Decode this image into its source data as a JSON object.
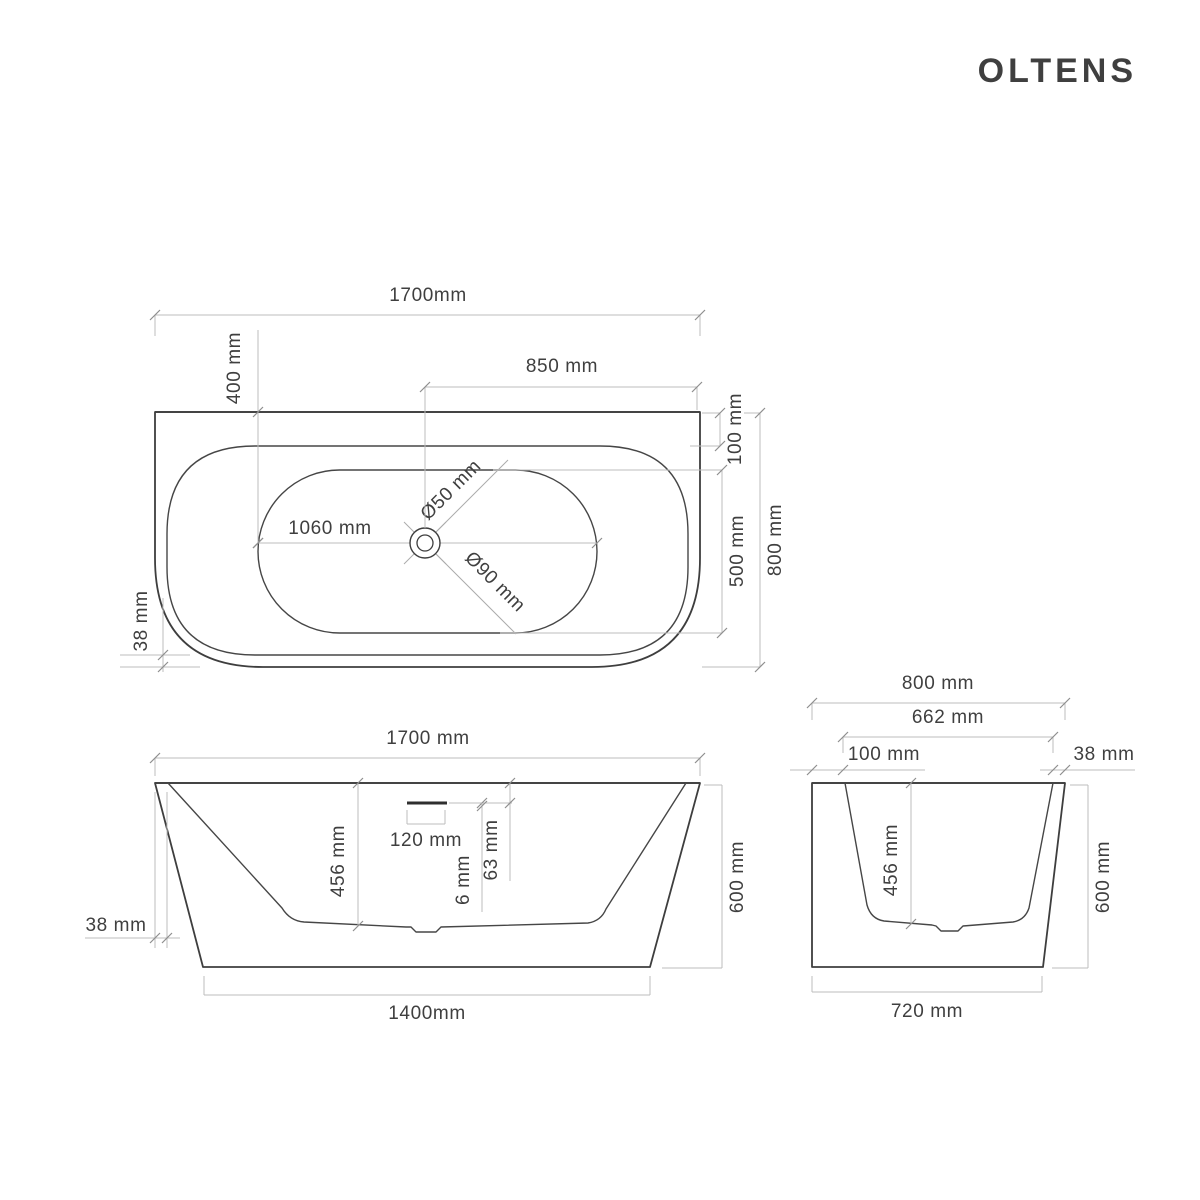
{
  "brand": {
    "logo": "OLTENS"
  },
  "colors": {
    "outline": "#3e3e3e",
    "dimension_lines": "#bcbcbc",
    "text": "#3f3f3f",
    "logo": "#242e4c"
  },
  "views": {
    "top": {
      "title": "top-view-of-bathtub",
      "dims": {
        "overall_length": "1700mm",
        "drain_to_right_edge": "850 mm",
        "back_edge_to_drain": "400 mm",
        "back_rim_width": "100 mm",
        "basin_width": "500 mm",
        "overall_width": "800 mm",
        "basin_length": "1060 mm",
        "drain_hole": "Ø50 mm",
        "drain_flange": "Ø90 mm",
        "wall_thickness": "38 mm"
      }
    },
    "front": {
      "title": "front-view-of-bathtub",
      "dims": {
        "overall_length": "1700 mm",
        "overflow_width": "120 mm",
        "inner_depth": "456 mm",
        "overflow_from_top": "63 mm",
        "bottom_slope": "6 mm",
        "overall_height": "600 mm",
        "base_length": "1400mm",
        "wall_thickness": "38 mm"
      }
    },
    "side": {
      "title": "side-view-of-bathtub",
      "dims": {
        "overall_width": "800 mm",
        "inner_width": "662 mm",
        "back_rim_width": "100 mm",
        "front_rim_width": "38 mm",
        "inner_depth": "456 mm",
        "overall_height": "600 mm",
        "base_width": "720 mm"
      }
    }
  }
}
